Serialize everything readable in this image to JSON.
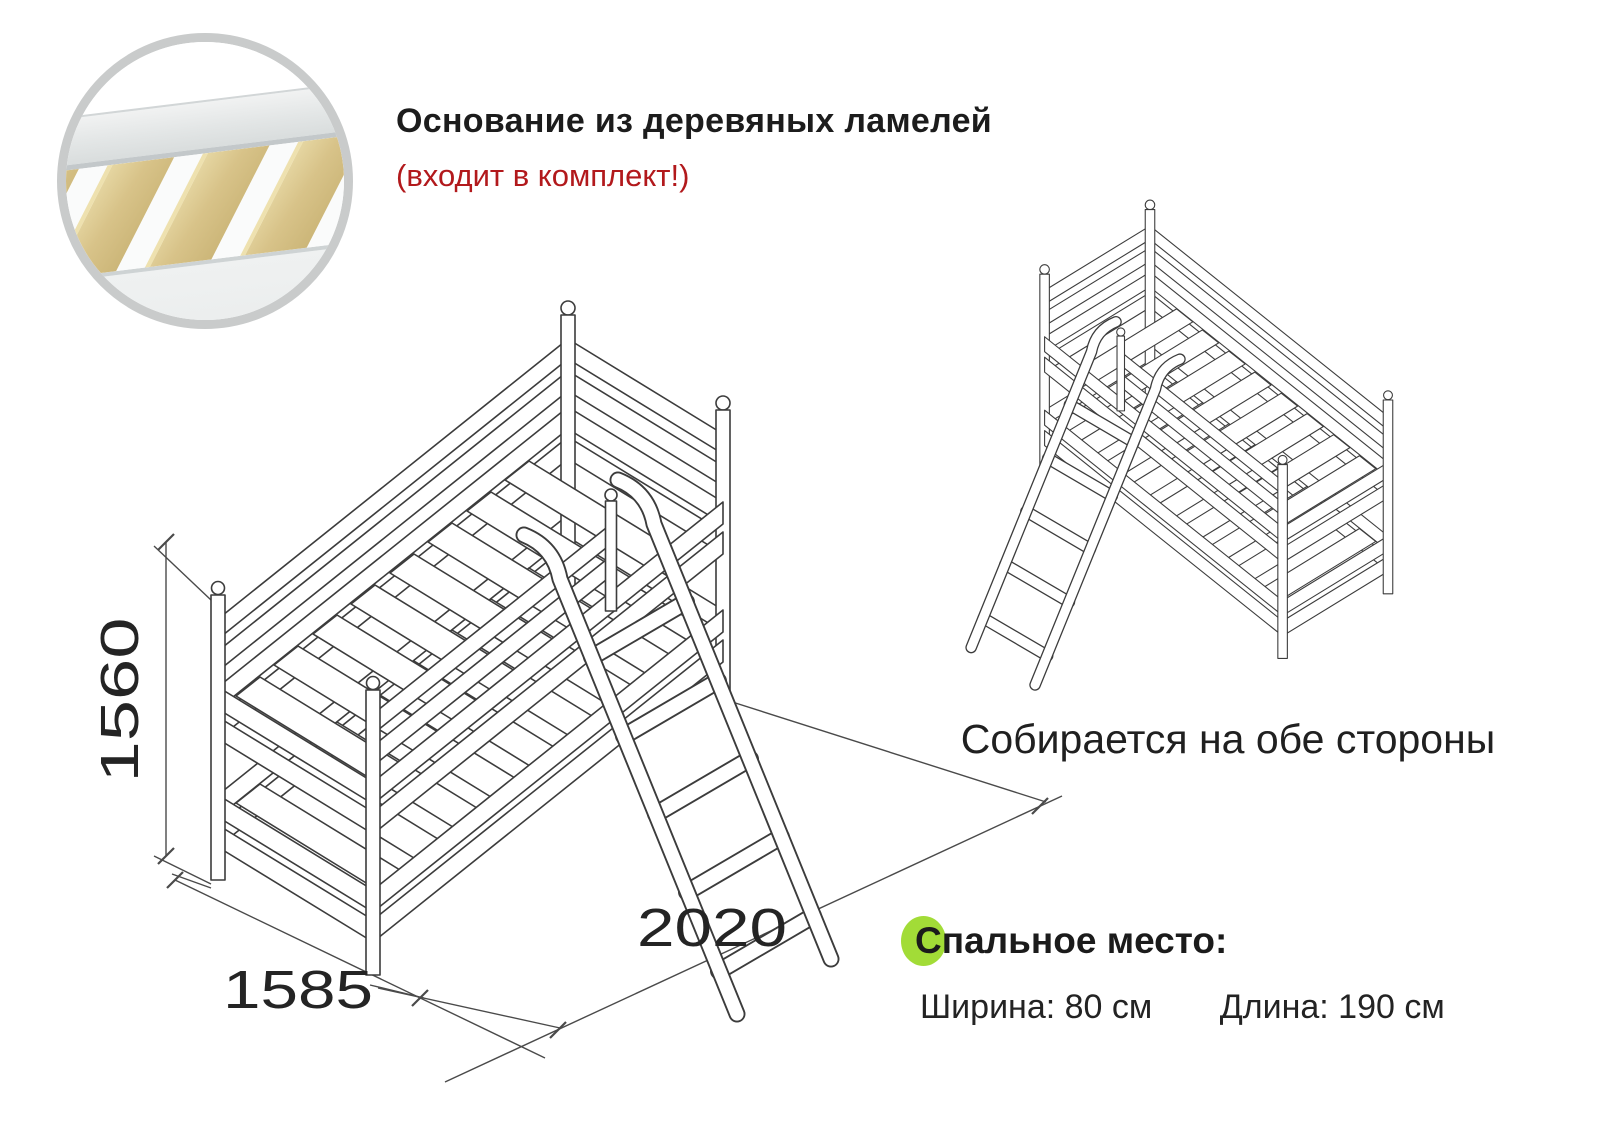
{
  "header": {
    "title": "Основание из деревяных ламелей",
    "subtitle": "(входит в комплект!)"
  },
  "left_figure": {
    "description": "bunk bed line drawing with ladder and dimensions",
    "dim_height": "1560",
    "dim_width": "1585",
    "dim_length": "2020"
  },
  "right_figure": {
    "description": "mirrored bunk bed line drawing",
    "caption": "Собирается на обе стороны"
  },
  "sleeping_area": {
    "title": "Спальное место:",
    "width": "Ширина: 80 см",
    "length": "Длина: 190 см"
  },
  "colors": {
    "text": "#1f1f1f",
    "accent_red": "#b2191c",
    "accent_green": "#a2dc37",
    "line_art": "#3c3c3c",
    "inset_ring": "#c9cbcb",
    "slat_wood": "#d8c389"
  }
}
